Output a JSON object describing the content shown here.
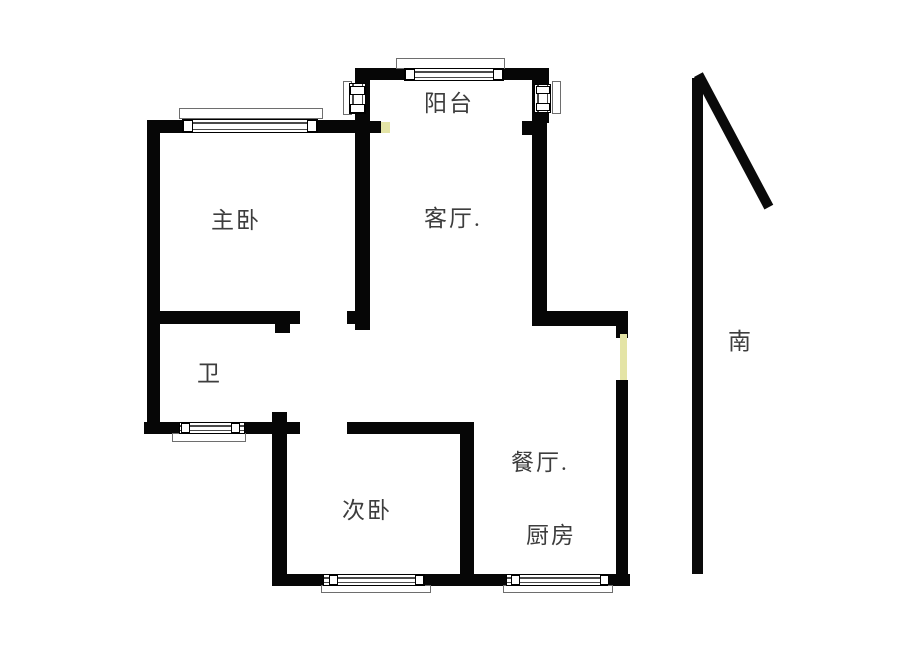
{
  "plan": {
    "type": "apartment-floor-plan",
    "background": "#ffffff",
    "wall_color": "#060606",
    "door_marker_color": "#e4e4a6",
    "label_color": "#3d3d3d"
  },
  "rooms": {
    "balcony": {
      "label": "阳台"
    },
    "master_bedroom": {
      "label": "主卧"
    },
    "living_room": {
      "label": "客厅."
    },
    "bathroom": {
      "label": "卫"
    },
    "second_bedroom": {
      "label": "次卧"
    },
    "dining_room": {
      "label": "餐厅."
    },
    "kitchen": {
      "label": "厨房"
    }
  },
  "compass": {
    "south_label": "南"
  }
}
